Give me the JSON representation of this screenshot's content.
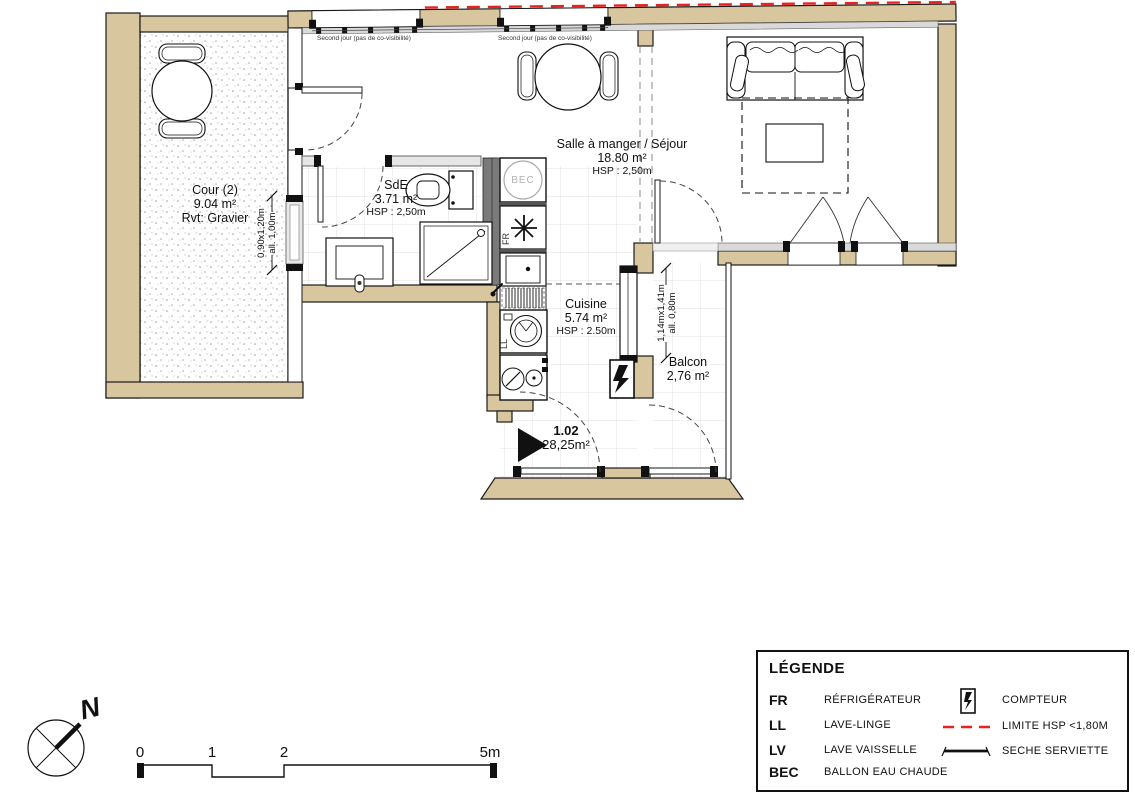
{
  "colors": {
    "wall": "#d8c69e",
    "red_limit": "#e8231f",
    "sill": "#d9d9d9",
    "grid": "#e0e0e0",
    "dark_partition": "#7a7a7a"
  },
  "rooms": {
    "cour": {
      "name": "Cour (2)",
      "area": "9.04 m²",
      "note": "Rvt: Gravier"
    },
    "sde": {
      "name": "SdE",
      "area": "3.71 m²",
      "hsp": "HSP : 2,50m"
    },
    "sejour": {
      "name": "Salle à manger / Séjour",
      "area": "18.80 m²",
      "hsp": "HSP : 2,50m"
    },
    "cuisine": {
      "name": "Cuisine",
      "area": "5.74 m²",
      "hsp": "HSP : 2.50m"
    },
    "balcon": {
      "name": "Balcon",
      "area": "2,76 m²"
    }
  },
  "unit": {
    "number": "1.02",
    "area": "28,25m²"
  },
  "window_notes": {
    "left": "Second jour (pas de co-visibilité)",
    "right": "Second jour (pas de co-visibilité)"
  },
  "dimensions": {
    "left_window": {
      "line1": "0,90x1,20m",
      "line2": "all. 1,00m"
    },
    "balcony_window": {
      "line1": "1,14mx1,41m",
      "line2": "all. 0,80m"
    }
  },
  "appliances": {
    "bec": "BEC",
    "fr": "FR",
    "ll": "LL"
  },
  "legend": {
    "title": "LÉGENDE",
    "abbreviations": [
      {
        "abbr": "FR",
        "label": "RÉFRIGÉRATEUR"
      },
      {
        "abbr": "LL",
        "label": "LAVE-LINGE"
      },
      {
        "abbr": "LV",
        "label": "LAVE VAISSELLE"
      },
      {
        "abbr": "BEC",
        "label": "BALLON EAU CHAUDE"
      }
    ],
    "symbols": [
      {
        "icon": "compteur-icon",
        "label": "COMPTEUR"
      },
      {
        "icon": "hsp-limit-line",
        "label": "LIMITE HSP <1,80M"
      },
      {
        "icon": "towel-rail-icon",
        "label": "SECHE SERVIETTE"
      }
    ]
  },
  "scale_bar": {
    "t0": "0",
    "t1": "1",
    "t2": "2",
    "t5": "5m"
  },
  "north": {
    "label": "N"
  }
}
